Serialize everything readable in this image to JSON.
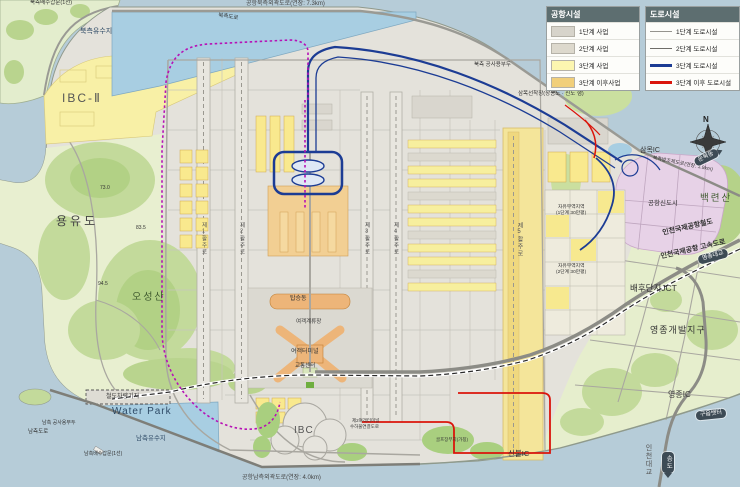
{
  "legend": {
    "airport": {
      "title": "공항시설",
      "items": [
        {
          "label": "1단계 사업",
          "color": "#d7d4cb"
        },
        {
          "label": "2단계 사업",
          "color": "#ddd9cd"
        },
        {
          "label": "3단계 사업",
          "color": "#fcf6b0"
        },
        {
          "label": "3단계 이후사업",
          "color": "#f1cf7a"
        }
      ]
    },
    "road": {
      "title": "도로시설",
      "items": [
        {
          "label": "1단계 도로시설",
          "color": "#96948f"
        },
        {
          "label": "2단계 도로시설",
          "color": "#6f6d68"
        },
        {
          "label": "3단계 도로시설",
          "color": "#1c3c94"
        },
        {
          "label": "3단계 이후 도로시설",
          "color": "#da150b"
        }
      ]
    }
  },
  "compass": {
    "north": "N"
  },
  "map_labels": {
    "north_outer_road": "공항북측외곽도로(연장: 7.3km)",
    "north_sluice": "북측배수갑문(1선)",
    "north_reservoir": "북측유수지",
    "north_side_road": "북측도로",
    "ibc2": "IBC-Ⅱ",
    "north_dock": "북측 공사용부두",
    "sammok_dock": "삼목선착장(장봉도 · 신도 행)",
    "sammok_ic": "삼목IC",
    "north_seawall_road": "북측방조제도로(연장: 3.9km)",
    "baeknyeonsan": "백련산",
    "airport_newtown": "공항신도시",
    "airport_railroad": "인천국제공항철도",
    "airport_expressway": "인천국제공항 고속도로",
    "baehudanji_jct": "배후단지JCT",
    "yeongjong_dev": "영종개발지구",
    "yeongjong_ic": "영종IC",
    "incheon_bridge": "인천대교",
    "shinbul_ic": "신불IC",
    "golf_site": "골프장부지(가칭)",
    "t2_baggage_road_1": "제2여객터미널",
    "t2_baggage_road_2": "수하물연결도로",
    "south_outer_road": "공항남측외곽도로(연장: 4.0km)",
    "ibc1": "IBC",
    "south_side_road": "남측도로",
    "south_dock": "남측 공사용부두",
    "south_sluice": "남측배수갑문(1선)",
    "water_park": "Water Park",
    "south_reservoir": "남측유수지",
    "rail_depot": "철도차량기지",
    "yongyudo": "용유도",
    "oseongsan": "오성산",
    "elev_1": "73.0",
    "elev_2": "83.5",
    "elev_3": "94.5",
    "boarding_concourse": "탑승동",
    "passenger_apron": "여객계류장",
    "passenger_terminal": "여객터미널",
    "transport_center": "교통센터",
    "runway1": "제1활주로",
    "runway2": "제2활주로",
    "runway3": "제3활주로",
    "runway4": "제4활주로",
    "runway5": "제5활주로",
    "free_trade_1a": "자유무역지역",
    "free_trade_1b": "(1단계 30만평)",
    "free_trade_2a": "자유무역지역",
    "free_trade_2b": "(2단계 30만평)"
  },
  "badges": {
    "yeongjong_bridge": "영종대교",
    "gueup_ferry": "구읍뱃터",
    "unbuk_dong": "운북동",
    "songdo": "송도"
  },
  "colors": {
    "sea": "#b6ccd8",
    "platform": "#e4e2db",
    "vegetation": "#e8efd0",
    "hill": "#c3da9b",
    "phase3_yellow": "#fcf6b0",
    "post_phase3_gold": "#f1cf7a",
    "newtown_pink": "#e7d2e7",
    "water": "#a8cee2",
    "road3_blue": "#1c3c94",
    "road_post3_red": "#da150b",
    "maglev_magenta": "#b611b6"
  }
}
